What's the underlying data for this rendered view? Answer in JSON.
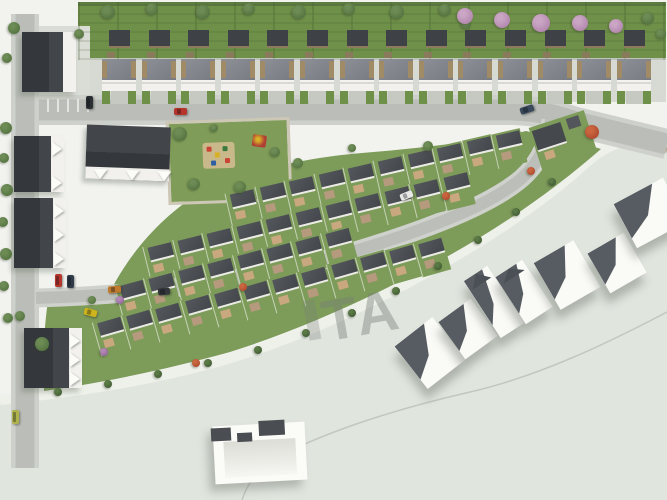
{
  "image_type": "aerial 3D site plan rendering of a residential housing estate",
  "watermark": {
    "visible_text": "TA"
  },
  "palette": {
    "page_bg": "#fdfdfc",
    "ground": "#f2f3ef",
    "undeveloped": "#e0e5de",
    "verge": "#eef1ea",
    "grass_top": "#6f9049",
    "grass_mid": "#7d9b59",
    "road": "#bbbeb8",
    "sidewalk": "#ced1cb",
    "roof_dark": "#3e4246",
    "roof_main_gray": "#83878d",
    "roof_unit": "#4a4e53",
    "facade_white": "#f2f1ed",
    "patio_tan": "#c9a87f",
    "white_house": "#fafaf7",
    "white_house_roof": "#565c61",
    "tree_green": "#557441",
    "tree_pink": "#b387ae",
    "tree_red": "#b04a2f",
    "watermark_color": "rgba(118,126,118,0.42)"
  },
  "scene": {
    "paths": {
      "undeveloped": "M667,130 C640,130 610,137 585,158 C550,190 500,226 440,260 C370,300 290,337 215,358 C150,376 80,388 0,396 L0,500 L667,500 Z",
      "verge": "M0,400 C80,392 152,380 217,362 C292,341 372,304 442,264 C502,230 552,194 587,162 C611,141 641,134 667,134",
      "greenband": "M204,190 C244,172 302,158 362,153 C422,148 482,141 526,131 C554,138 580,142 601,149 C560,185 506,224 450,255 C380,294 300,330 230,352 C172,368 108,382 44,391 C42,360 44,330 48,300 C70,296 96,292 112,288 C132,250 164,214 204,190 Z",
      "top_road": "M12,110 L512,110 C542,111 558,116 576,122 L667,144",
      "left_road": "M25,14 L25,468",
      "mid_road": "M36,298 C150,295 262,279 352,252 C432,228 492,204 522,178 C542,160 548,140 551,120",
      "inner_curve": "M667,312 C610,342 540,376 470,392 C400,408 330,430 282,455 C262,466 248,480 242,500",
      "gravel_edge": "M560,128 C600,136 640,144 667,150",
      "parking_lines": "M48,99 L48,112 M58,99 L58,112 M68,99 L68,112 M78,99 L78,112 M88,99 L88,112"
    },
    "top_row": {
      "count": 14,
      "x": 100,
      "y": 28,
      "step": 39.6
    },
    "mid_rows": [
      {
        "x": 228,
        "y": 190,
        "n": 10,
        "dx": 29.6,
        "dy": -6.6,
        "rot": -13
      },
      {
        "x": 146,
        "y": 243,
        "n": 11,
        "dx": 29.6,
        "dy": -7.0,
        "rot": -14
      },
      {
        "x": 118,
        "y": 281,
        "n": 8,
        "dx": 29.4,
        "dy": -7.4,
        "rot": -15
      },
      {
        "x": 96,
        "y": 318,
        "n": 12,
        "dx": 29.2,
        "dy": -7.2,
        "rot": -16
      }
    ],
    "left_buildings": [
      {
        "x": 22,
        "y": 32,
        "w": 54,
        "h": 60,
        "rot": 0,
        "white_side": "right",
        "triangles": 0
      },
      {
        "x": 14,
        "y": 136,
        "w": 50,
        "h": 56,
        "rot": 0,
        "white_side": "right",
        "triangles": 2
      },
      {
        "x": 14,
        "y": 198,
        "w": 52,
        "h": 70,
        "rot": 0,
        "white_side": "right",
        "triangles": 3
      },
      {
        "x": 86,
        "y": 126,
        "w": 84,
        "h": 54,
        "rot": 2,
        "white_side": "bottom",
        "triangles": 3
      },
      {
        "x": 24,
        "y": 328,
        "w": 58,
        "h": 60,
        "rot": 0,
        "white_side": "right",
        "triangles": 3
      }
    ],
    "corner_house": {
      "x": 534,
      "y": 118,
      "rot": -18
    },
    "white_houses": [
      {
        "x": 406,
        "y": 326,
        "w": 48,
        "h": 54,
        "rot": -38,
        "gable": false
      },
      {
        "x": 448,
        "y": 306,
        "w": 40,
        "h": 46,
        "rot": -36,
        "gable": false
      },
      {
        "x": 480,
        "y": 268,
        "w": 28,
        "h": 68,
        "rot": -33,
        "gable": true
      },
      {
        "x": 508,
        "y": 264,
        "w": 32,
        "h": 56,
        "rot": -33,
        "gable": true
      },
      {
        "x": 544,
        "y": 248,
        "w": 46,
        "h": 54,
        "rot": -30,
        "gable": false
      },
      {
        "x": 596,
        "y": 240,
        "w": 42,
        "h": 46,
        "rot": -30,
        "gable": false
      },
      {
        "x": 622,
        "y": 188,
        "w": 56,
        "h": 50,
        "rot": -28,
        "gable": false
      }
    ],
    "u_building": {
      "x": 214,
      "y": 424,
      "w": 92,
      "h": 58,
      "rot": -3
    },
    "park": {
      "x": 170,
      "y": 122,
      "w": 118,
      "h": 78,
      "rot": -2
    },
    "cars": [
      [
        174,
        108,
        13,
        7,
        0,
        "#b5342c"
      ],
      [
        86,
        96,
        7,
        13,
        0,
        "#2c3033"
      ],
      [
        520,
        106,
        14,
        7,
        -18,
        "#3a4a5c"
      ],
      [
        400,
        192,
        13,
        7,
        -22,
        "#e8e8e6"
      ],
      [
        108,
        286,
        13,
        7,
        -4,
        "#bf7a2e"
      ],
      [
        158,
        288,
        12,
        7,
        -6,
        "#33373b"
      ],
      [
        55,
        274,
        7,
        13,
        0,
        "#b5342c"
      ],
      [
        67,
        275,
        7,
        13,
        0,
        "#2e3a48"
      ],
      [
        84,
        309,
        13,
        7,
        14,
        "#cdb31c"
      ],
      [
        12,
        410,
        7,
        14,
        0,
        "#b0b24a"
      ]
    ],
    "trees": [
      [
        108,
        12,
        7,
        "g"
      ],
      [
        152,
        9,
        6,
        "g"
      ],
      [
        203,
        12,
        7,
        "g"
      ],
      [
        249,
        9,
        6,
        "g"
      ],
      [
        299,
        12,
        7,
        "g"
      ],
      [
        349,
        9,
        6,
        "g"
      ],
      [
        397,
        12,
        7,
        "g"
      ],
      [
        445,
        10,
        6,
        "g"
      ],
      [
        466,
        24,
        5,
        "g"
      ],
      [
        465,
        16,
        8,
        "p"
      ],
      [
        502,
        20,
        8,
        "p"
      ],
      [
        541,
        23,
        9,
        "p"
      ],
      [
        580,
        23,
        8,
        "p"
      ],
      [
        616,
        26,
        7,
        "p"
      ],
      [
        648,
        18,
        6,
        "g"
      ],
      [
        661,
        34,
        5,
        "g"
      ],
      [
        14,
        28,
        6,
        "g"
      ],
      [
        7,
        58,
        5,
        "g"
      ],
      [
        79,
        34,
        5,
        "g"
      ],
      [
        6,
        128,
        6,
        "g"
      ],
      [
        4,
        158,
        5,
        "g"
      ],
      [
        7,
        190,
        6,
        "g"
      ],
      [
        3,
        222,
        5,
        "g"
      ],
      [
        6,
        254,
        6,
        "g"
      ],
      [
        4,
        286,
        5,
        "g"
      ],
      [
        8,
        318,
        5,
        "g"
      ],
      [
        180,
        134,
        7,
        "g"
      ],
      [
        194,
        184,
        6,
        "g"
      ],
      [
        240,
        187,
        6,
        "g"
      ],
      [
        275,
        152,
        5,
        "g"
      ],
      [
        214,
        128,
        4,
        "g"
      ],
      [
        298,
        163,
        5,
        "g"
      ],
      [
        352,
        148,
        4,
        "g"
      ],
      [
        428,
        146,
        5,
        "g"
      ],
      [
        592,
        132,
        7,
        "r"
      ],
      [
        446,
        196,
        4,
        "r"
      ],
      [
        531,
        171,
        4,
        "r"
      ],
      [
        243,
        287,
        4,
        "r"
      ],
      [
        196,
        363,
        4,
        "r"
      ],
      [
        104,
        352,
        4,
        "u"
      ],
      [
        120,
        300,
        4,
        "u"
      ],
      [
        552,
        182,
        4,
        "d"
      ],
      [
        516,
        212,
        4,
        "d"
      ],
      [
        478,
        240,
        4,
        "d"
      ],
      [
        438,
        266,
        4,
        "d"
      ],
      [
        396,
        291,
        4,
        "d"
      ],
      [
        352,
        313,
        4,
        "d"
      ],
      [
        306,
        333,
        4,
        "d"
      ],
      [
        258,
        350,
        4,
        "d"
      ],
      [
        208,
        363,
        4,
        "d"
      ],
      [
        158,
        374,
        4,
        "d"
      ],
      [
        108,
        384,
        4,
        "d"
      ],
      [
        58,
        392,
        4,
        "d"
      ],
      [
        42,
        344,
        7,
        "g"
      ],
      [
        20,
        316,
        5,
        "g"
      ],
      [
        92,
        300,
        4,
        "g"
      ]
    ]
  }
}
